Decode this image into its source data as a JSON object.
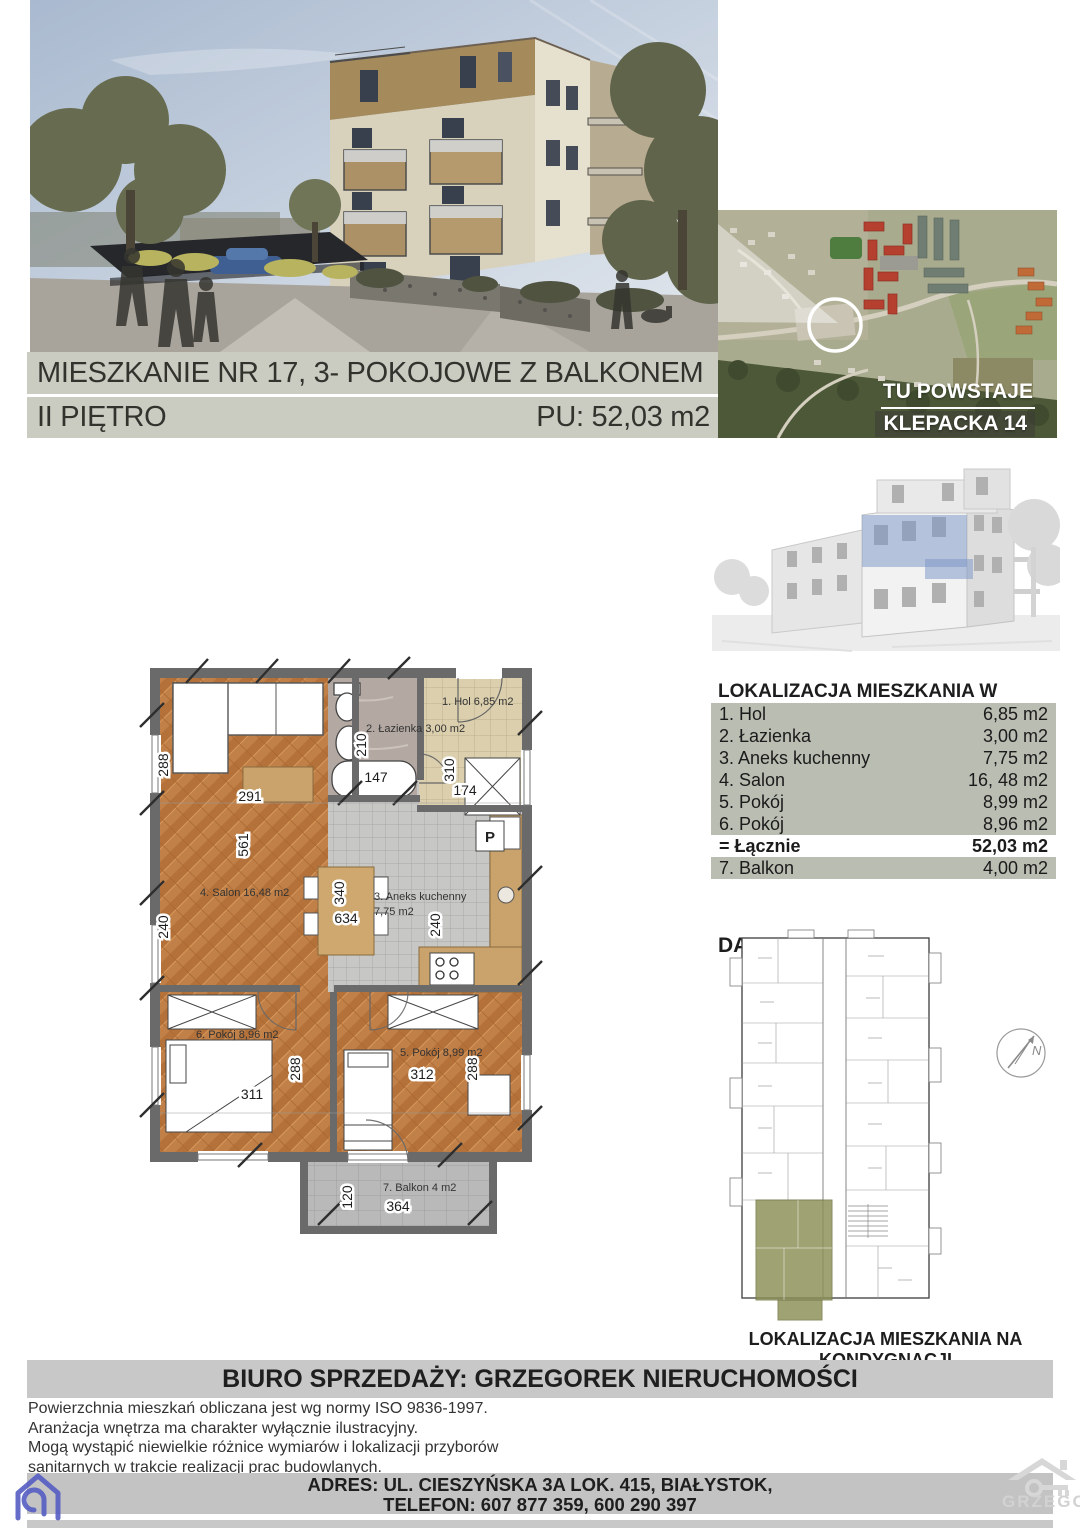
{
  "brand": {
    "line1": "MOJE PIERWSZE",
    "line2": "MIESZKANIE",
    "line3": "W BIAŁYMSTOKU"
  },
  "location_map": {
    "tagline_top": "TU POWSTAJE",
    "tagline_bottom": "KLEPACKA 14"
  },
  "header": {
    "title": "MIESZKANIE NR 17, 3- POKOJOWE Z BALKONEM",
    "floor": "II PIĘTRO",
    "usable_area": "PU: 52,03 m2"
  },
  "building_location": {
    "heading": "LOKALIZACJA MIESZKANIA W BUDYNKU"
  },
  "rooms_table": {
    "rows": [
      {
        "label": "1. Hol",
        "area": "6,85 m2"
      },
      {
        "label": "2. Łazienka",
        "area": "3,00 m2"
      },
      {
        "label": "3. Aneks kuchenny",
        "area": "7,75 m2"
      },
      {
        "label": "4. Salon",
        "area": "16, 48 m2"
      },
      {
        "label": "5. Pokój",
        "area": "8,99 m2"
      },
      {
        "label": "6. Pokój",
        "area": "8,96 m2"
      }
    ],
    "total": {
      "label": "= Łącznie",
      "area": "52,03 m2"
    },
    "extra": {
      "label": "7. Balkon",
      "area": "4,00 m2"
    }
  },
  "floor_plan_section": {
    "heading": "DANE METRAŻOWE",
    "caption": "LOKALIZACJA MIESZKANIA NA KONDYGNACJI",
    "compass_label": "N"
  },
  "apartment_plan": {
    "room_labels": {
      "hol": "1. Hol 6,85 m2",
      "lazienka": "2. Łazienka 3,00 m2",
      "aneks_line1": "3. Aneks kuchenny",
      "aneks_line2": "7,75 m2",
      "salon": "4. Salon 16,48 m2",
      "pokoj5": "5. Pokój 8,99 m2",
      "pokoj6": "6. Pokój 8,96 m2",
      "balkon": "7. Balkon 4 m2"
    },
    "dimensions": {
      "salon_top": "288",
      "salon_w": "291",
      "salon_h": "561",
      "salon_bottom": "240",
      "lazienka_h": "210",
      "lazienka_w": "147",
      "hol_h": "310",
      "hol_w": "174",
      "aneks_h": "340",
      "aneks_w": "634",
      "aneks_right": "240",
      "pokoj6_w": "311",
      "pokoj6_h": "288",
      "pokoj5_w": "312",
      "pokoj5_h": "288",
      "balkon_h": "120",
      "balkon_w": "364"
    },
    "washer_label": "P"
  },
  "sales_office": {
    "header": "BIURO SPRZEDAŻY: GRZEGOREK NIERUCHOMOŚCI",
    "disclaimers": [
      "Powierzchnia mieszkań obliczana jest wg normy ISO 9836-1997.",
      "Aranżacja wnętrza ma charakter wyłącznie ilustracyjny.",
      "Mogą wystąpić niewielkie różnice wymiarów i lokalizacji przyborów",
      "sanitarnych w trakcie realizacji prac budowlanych."
    ],
    "address": "ADRES: UL. CIESZYŃSKA 3A LOK. 415, BIAŁYSTOK,",
    "phone": "TELEFON: 607 877 359, 600 290 397",
    "watermark": "GRZEGO"
  },
  "colors": {
    "accent_navy": "#1c2b4a",
    "band_gray": "#b9bdb2",
    "bar_gray": "#caccc2",
    "highlight_blue": "#7d96c8",
    "highlight_olive": "#8a9055",
    "logo_indigo": "#565ec4"
  }
}
